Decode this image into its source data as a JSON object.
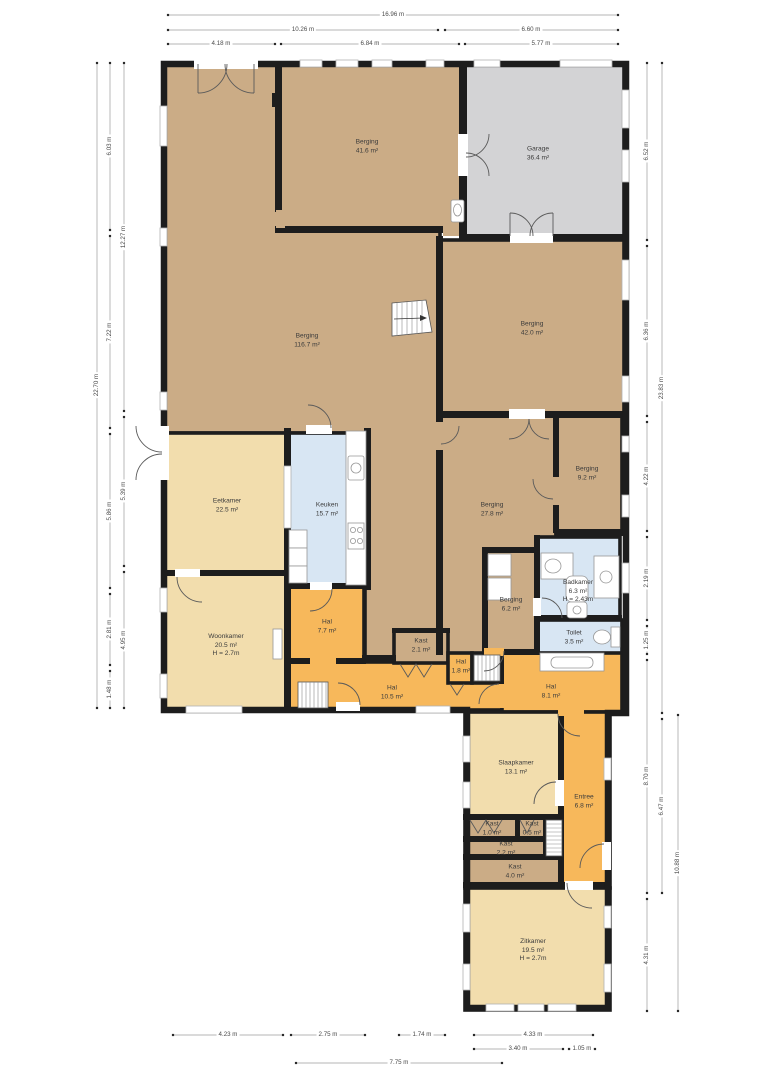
{
  "page": {
    "background": "#ffffff",
    "type": "floor-plan"
  },
  "colors": {
    "storage": "#cbac86",
    "living": "#f2ddad",
    "hall": "#f7b85b",
    "wet": "#d8e6f3",
    "garage": "#d3d3d5",
    "wall": "#1d1d1d"
  },
  "rooms": [
    {
      "name": "Berging",
      "area": "41.6 m²"
    },
    {
      "name": "Garage",
      "area": "36.4 m²"
    },
    {
      "name": "Berging",
      "area": "116.7 m²"
    },
    {
      "name": "Berging",
      "area": "42.0 m²"
    },
    {
      "name": "Eetkamer",
      "area": "22.5 m²"
    },
    {
      "name": "Keuken",
      "area": "15.7 m²"
    },
    {
      "name": "Berging",
      "area": "27.8 m²"
    },
    {
      "name": "Berging",
      "area": "9.2 m²"
    },
    {
      "name": "Woonkamer",
      "area": "20.5 m²",
      "height": "H = 2.7m"
    },
    {
      "name": "Hal",
      "area": "7.7 m²"
    },
    {
      "name": "Berging",
      "area": "6.2 m²"
    },
    {
      "name": "Badkamer",
      "area": "6.3 m²",
      "height": "H = 2.43m"
    },
    {
      "name": "Toilet",
      "area": "3.5 m²"
    },
    {
      "name": "Kast",
      "area": "2.1 m²"
    },
    {
      "name": "Hal",
      "area": "1.8 m²"
    },
    {
      "name": "Hal",
      "area": "10.5 m²"
    },
    {
      "name": "Hal",
      "area": "8.1 m²"
    },
    {
      "name": "Slaapkamer",
      "area": "13.1 m²"
    },
    {
      "name": "Entree",
      "area": "6.8 m²"
    },
    {
      "name": "Kast",
      "area": "1.0 m²"
    },
    {
      "name": "Kast",
      "area": "0.5 m²"
    },
    {
      "name": "Kast",
      "area": "2.2 m²"
    },
    {
      "name": "Kast",
      "area": "4.0 m²"
    },
    {
      "name": "Zitkamer",
      "area": "19.5 m²",
      "height": "H = 2.7m"
    }
  ],
  "dims": {
    "top": [
      "16.96 m",
      "10.26 m",
      "6.60 m",
      "4.18 m",
      "6.84 m",
      "5.77 m"
    ],
    "left": [
      "22.70 m",
      "6.03 m",
      "7.22 m",
      "5.86 m",
      "2.81 m",
      "1.48 m",
      "12.27 m",
      "5.39 m",
      "4.95 m"
    ],
    "right": [
      "6.52 m",
      "6.36 m",
      "4.22 m",
      "2.19 m",
      "1.25 m",
      "8.70 m",
      "4.31 m",
      "23.83 m",
      "6.47 m",
      "10.88 m"
    ],
    "bottom": [
      "4.23 m",
      "2.75 m",
      "1.74 m",
      "4.33 m",
      "3.40 m",
      "1.05 m",
      "7.75 m"
    ]
  }
}
